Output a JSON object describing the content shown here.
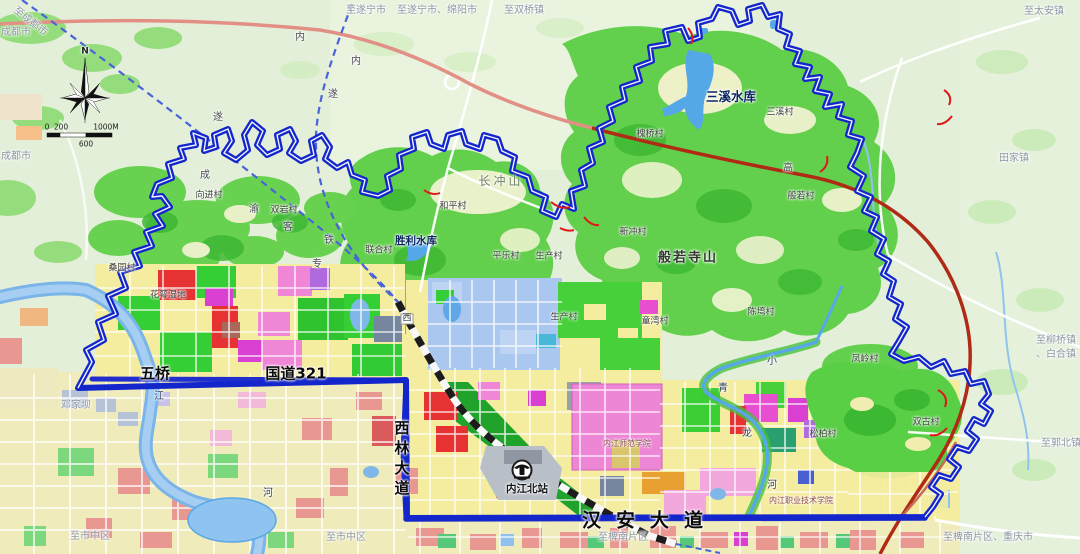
{
  "palette": {
    "boundary_blue": "#1226cc",
    "road_blue": "#1f2ecc",
    "highway_salmon": "#e29086",
    "expressway_dark_red": "#b02b16",
    "forest_green": "#62d04c",
    "park_green": "#2fc62f",
    "residential_yellow": "#f4ec9f",
    "commercial_pink": "#ee86d6",
    "industrial_magenta": "#d93fd0",
    "red_zone": "#e63232",
    "education_light_blue": "#a9c7ef",
    "water_blue": "#7fb8e8",
    "terrain_background": "#e3efd8"
  },
  "compass": {
    "north": "N"
  },
  "scalebar": {
    "ticks": [
      "0",
      "200",
      "600",
      "1000M"
    ]
  },
  "station": {
    "name": "内江北站"
  },
  "map_labels": [
    {
      "text": "至成都市",
      "x": 30,
      "y": 22,
      "cls": "edge",
      "rot": 38,
      "name": "edge-label-to-chengdu"
    },
    {
      "text": "成都市",
      "x": 16,
      "y": 33,
      "cls": "edge",
      "name": "edge-label-chengdushi"
    },
    {
      "text": "成都市",
      "x": 16,
      "y": 157,
      "cls": "edge",
      "name": "edge-label-chengdushi-2"
    },
    {
      "text": "至遂宁市",
      "x": 366,
      "y": 11,
      "cls": "edge",
      "name": "edge-label-to-suining"
    },
    {
      "text": "至遂宁市、绵阳市",
      "x": 437,
      "y": 11,
      "cls": "edge",
      "name": "edge-label-to-suining-mianyang"
    },
    {
      "text": "至双桥镇",
      "x": 524,
      "y": 11,
      "cls": "edge",
      "name": "edge-label-to-shuangqiao"
    },
    {
      "text": "至太安镇",
      "x": 1044,
      "y": 12,
      "cls": "edge",
      "name": "edge-label-to-taian"
    },
    {
      "text": "至柳桥镇",
      "x": 1056,
      "y": 341,
      "cls": "edge",
      "name": "edge-label-to-liuqiao"
    },
    {
      "text": "、白合镇",
      "x": 1056,
      "y": 355,
      "cls": "edge",
      "name": "edge-label-to-baihe"
    },
    {
      "text": "至郭北镇",
      "x": 1061,
      "y": 444,
      "cls": "edge",
      "name": "edge-label-to-guobei"
    },
    {
      "text": "至椑南片区",
      "x": 623,
      "y": 538,
      "cls": "edge",
      "name": "edge-label-to-pinan"
    },
    {
      "text": "至椑南片区、重庆市",
      "x": 988,
      "y": 538,
      "cls": "edge",
      "name": "edge-label-to-pinan-chongqing"
    },
    {
      "text": "至市中区",
      "x": 90,
      "y": 537,
      "cls": "edge",
      "name": "edge-label-to-shizhongqu-1"
    },
    {
      "text": "至市中区",
      "x": 346,
      "y": 538,
      "cls": "edge",
      "name": "edge-label-to-shizhongqu-2"
    },
    {
      "text": "田家镇",
      "x": 1014,
      "y": 159,
      "cls": "edge",
      "name": "town-label-tianjia"
    },
    {
      "text": "邓家坝",
      "x": 76,
      "y": 406,
      "cls": "edge",
      "name": "area-label-dengjiaba"
    },
    {
      "text": "三溪村",
      "x": 780,
      "y": 113,
      "cls": "village",
      "name": "village-label"
    },
    {
      "text": "槐桥村",
      "x": 650,
      "y": 135,
      "cls": "village",
      "name": "village-label"
    },
    {
      "text": "般若村",
      "x": 801,
      "y": 197,
      "cls": "village",
      "name": "village-label"
    },
    {
      "text": "新冲村",
      "x": 633,
      "y": 233,
      "cls": "village",
      "name": "village-label"
    },
    {
      "text": "和平村",
      "x": 453,
      "y": 207,
      "cls": "village",
      "name": "village-label"
    },
    {
      "text": "联合村",
      "x": 379,
      "y": 251,
      "cls": "village",
      "name": "village-label"
    },
    {
      "text": "平乐村",
      "x": 506,
      "y": 257,
      "cls": "village",
      "name": "village-label"
    },
    {
      "text": "生产村",
      "x": 549,
      "y": 257,
      "cls": "village",
      "name": "village-label"
    },
    {
      "text": "生产村",
      "x": 564,
      "y": 318,
      "cls": "village",
      "name": "village-label"
    },
    {
      "text": "向进村",
      "x": 209,
      "y": 196,
      "cls": "village",
      "name": "village-label"
    },
    {
      "text": "双岩村",
      "x": 284,
      "y": 211,
      "cls": "village",
      "name": "village-label"
    },
    {
      "text": "桑园村",
      "x": 122,
      "y": 269,
      "cls": "village",
      "name": "village-label"
    },
    {
      "text": "童湾村",
      "x": 655,
      "y": 322,
      "cls": "village",
      "name": "village-label"
    },
    {
      "text": "陈塆村",
      "x": 761,
      "y": 313,
      "cls": "village",
      "name": "village-label"
    },
    {
      "text": "凤岭村",
      "x": 865,
      "y": 360,
      "cls": "village",
      "name": "village-label"
    },
    {
      "text": "双古村",
      "x": 926,
      "y": 423,
      "cls": "village",
      "name": "village-label"
    },
    {
      "text": "松柏村",
      "x": 823,
      "y": 435,
      "cls": "village",
      "name": "village-label"
    },
    {
      "text": "花萼湿地",
      "x": 168,
      "y": 296,
      "cls": "village",
      "name": "park-label-huae"
    },
    {
      "text": "长冲山",
      "x": 501,
      "y": 181,
      "cls": "mountain",
      "name": "mountain-label-changchong"
    },
    {
      "text": "般若寺山",
      "x": 688,
      "y": 258,
      "cls": "mountainBig",
      "name": "mountain-label-banruosi"
    },
    {
      "text": "三溪水库",
      "x": 731,
      "y": 97,
      "cls": "water",
      "name": "reservoir-label-sanxi"
    },
    {
      "text": "胜利水库",
      "x": 416,
      "y": 241,
      "cls": "water2",
      "name": "reservoir-label-shengli"
    },
    {
      "text": "江",
      "x": 159,
      "y": 397,
      "cls": "waterchar",
      "name": "river-char"
    },
    {
      "text": "河",
      "x": 268,
      "y": 494,
      "cls": "waterchar",
      "name": "river-char"
    },
    {
      "text": "小",
      "x": 772,
      "y": 362,
      "cls": "waterchar",
      "name": "river-char"
    },
    {
      "text": "青",
      "x": 723,
      "y": 389,
      "cls": "waterchar",
      "name": "river-char"
    },
    {
      "text": "龙",
      "x": 747,
      "y": 434,
      "cls": "waterchar",
      "name": "river-char"
    },
    {
      "text": "河",
      "x": 772,
      "y": 486,
      "cls": "waterchar",
      "name": "river-char"
    },
    {
      "text": "成",
      "x": 205,
      "y": 176,
      "cls": "railchar",
      "name": "rail-char"
    },
    {
      "text": "渝",
      "x": 254,
      "y": 210,
      "cls": "railchar",
      "name": "rail-char"
    },
    {
      "text": "客",
      "x": 288,
      "y": 228,
      "cls": "railchar",
      "name": "rail-char"
    },
    {
      "text": "专",
      "x": 317,
      "y": 265,
      "cls": "railchar",
      "name": "rail-char"
    },
    {
      "text": "铁",
      "x": 329,
      "y": 241,
      "cls": "railchar",
      "name": "rail-char"
    },
    {
      "text": "内",
      "x": 356,
      "y": 62,
      "cls": "railchar",
      "name": "rail-char"
    },
    {
      "text": "遂",
      "x": 333,
      "y": 95,
      "cls": "railchar",
      "name": "rail-char"
    },
    {
      "text": "内",
      "x": 300,
      "y": 38,
      "cls": "railchar",
      "name": "road-char"
    },
    {
      "text": "遂",
      "x": 218,
      "y": 118,
      "cls": "railchar",
      "name": "road-char"
    },
    {
      "text": "高",
      "x": 788,
      "y": 169,
      "cls": "railchar",
      "name": "road-char"
    },
    {
      "text": "西",
      "x": 407,
      "y": 319,
      "cls": "roadbox",
      "name": "road-marker-xi"
    },
    {
      "text": "五桥",
      "x": 155,
      "y": 374,
      "cls": "roadmain",
      "name": "road-label-wuqiao"
    },
    {
      "text": "国道321",
      "x": 296,
      "y": 374,
      "cls": "roadmain",
      "name": "road-label-g321"
    },
    {
      "text": "汉安大道",
      "x": 650,
      "y": 521,
      "cls": "hanan",
      "name": "road-label-hanan-avenue"
    },
    {
      "text": "西林大道",
      "x": 401,
      "y": 460,
      "cls": "xilin",
      "name": "road-label-xilin-avenue"
    },
    {
      "text": "内江北站",
      "x": 527,
      "y": 489,
      "cls": "stationlbl",
      "name": "station-label-neijiangbei"
    },
    {
      "text": "内江师范学院",
      "x": 627,
      "y": 444,
      "cls": "poi",
      "name": "poi-label-normal-university"
    },
    {
      "text": "内江职业技术学院",
      "x": 801,
      "y": 501,
      "cls": "poi",
      "name": "poi-label-vocational-college"
    },
    {
      "text": "N",
      "x": 85,
      "y": 52,
      "cls": "compassN",
      "name": "compass-north-label"
    },
    {
      "text": "0",
      "x": 47,
      "y": 127,
      "cls": "scale",
      "name": "scalebar-tick"
    },
    {
      "text": "200",
      "x": 61,
      "y": 127,
      "cls": "scale",
      "name": "scalebar-tick"
    },
    {
      "text": "1000M",
      "x": 106,
      "y": 127,
      "cls": "scale",
      "name": "scalebar-tick"
    },
    {
      "text": "600",
      "x": 86,
      "y": 144,
      "cls": "scale",
      "name": "scalebar-tick"
    }
  ]
}
